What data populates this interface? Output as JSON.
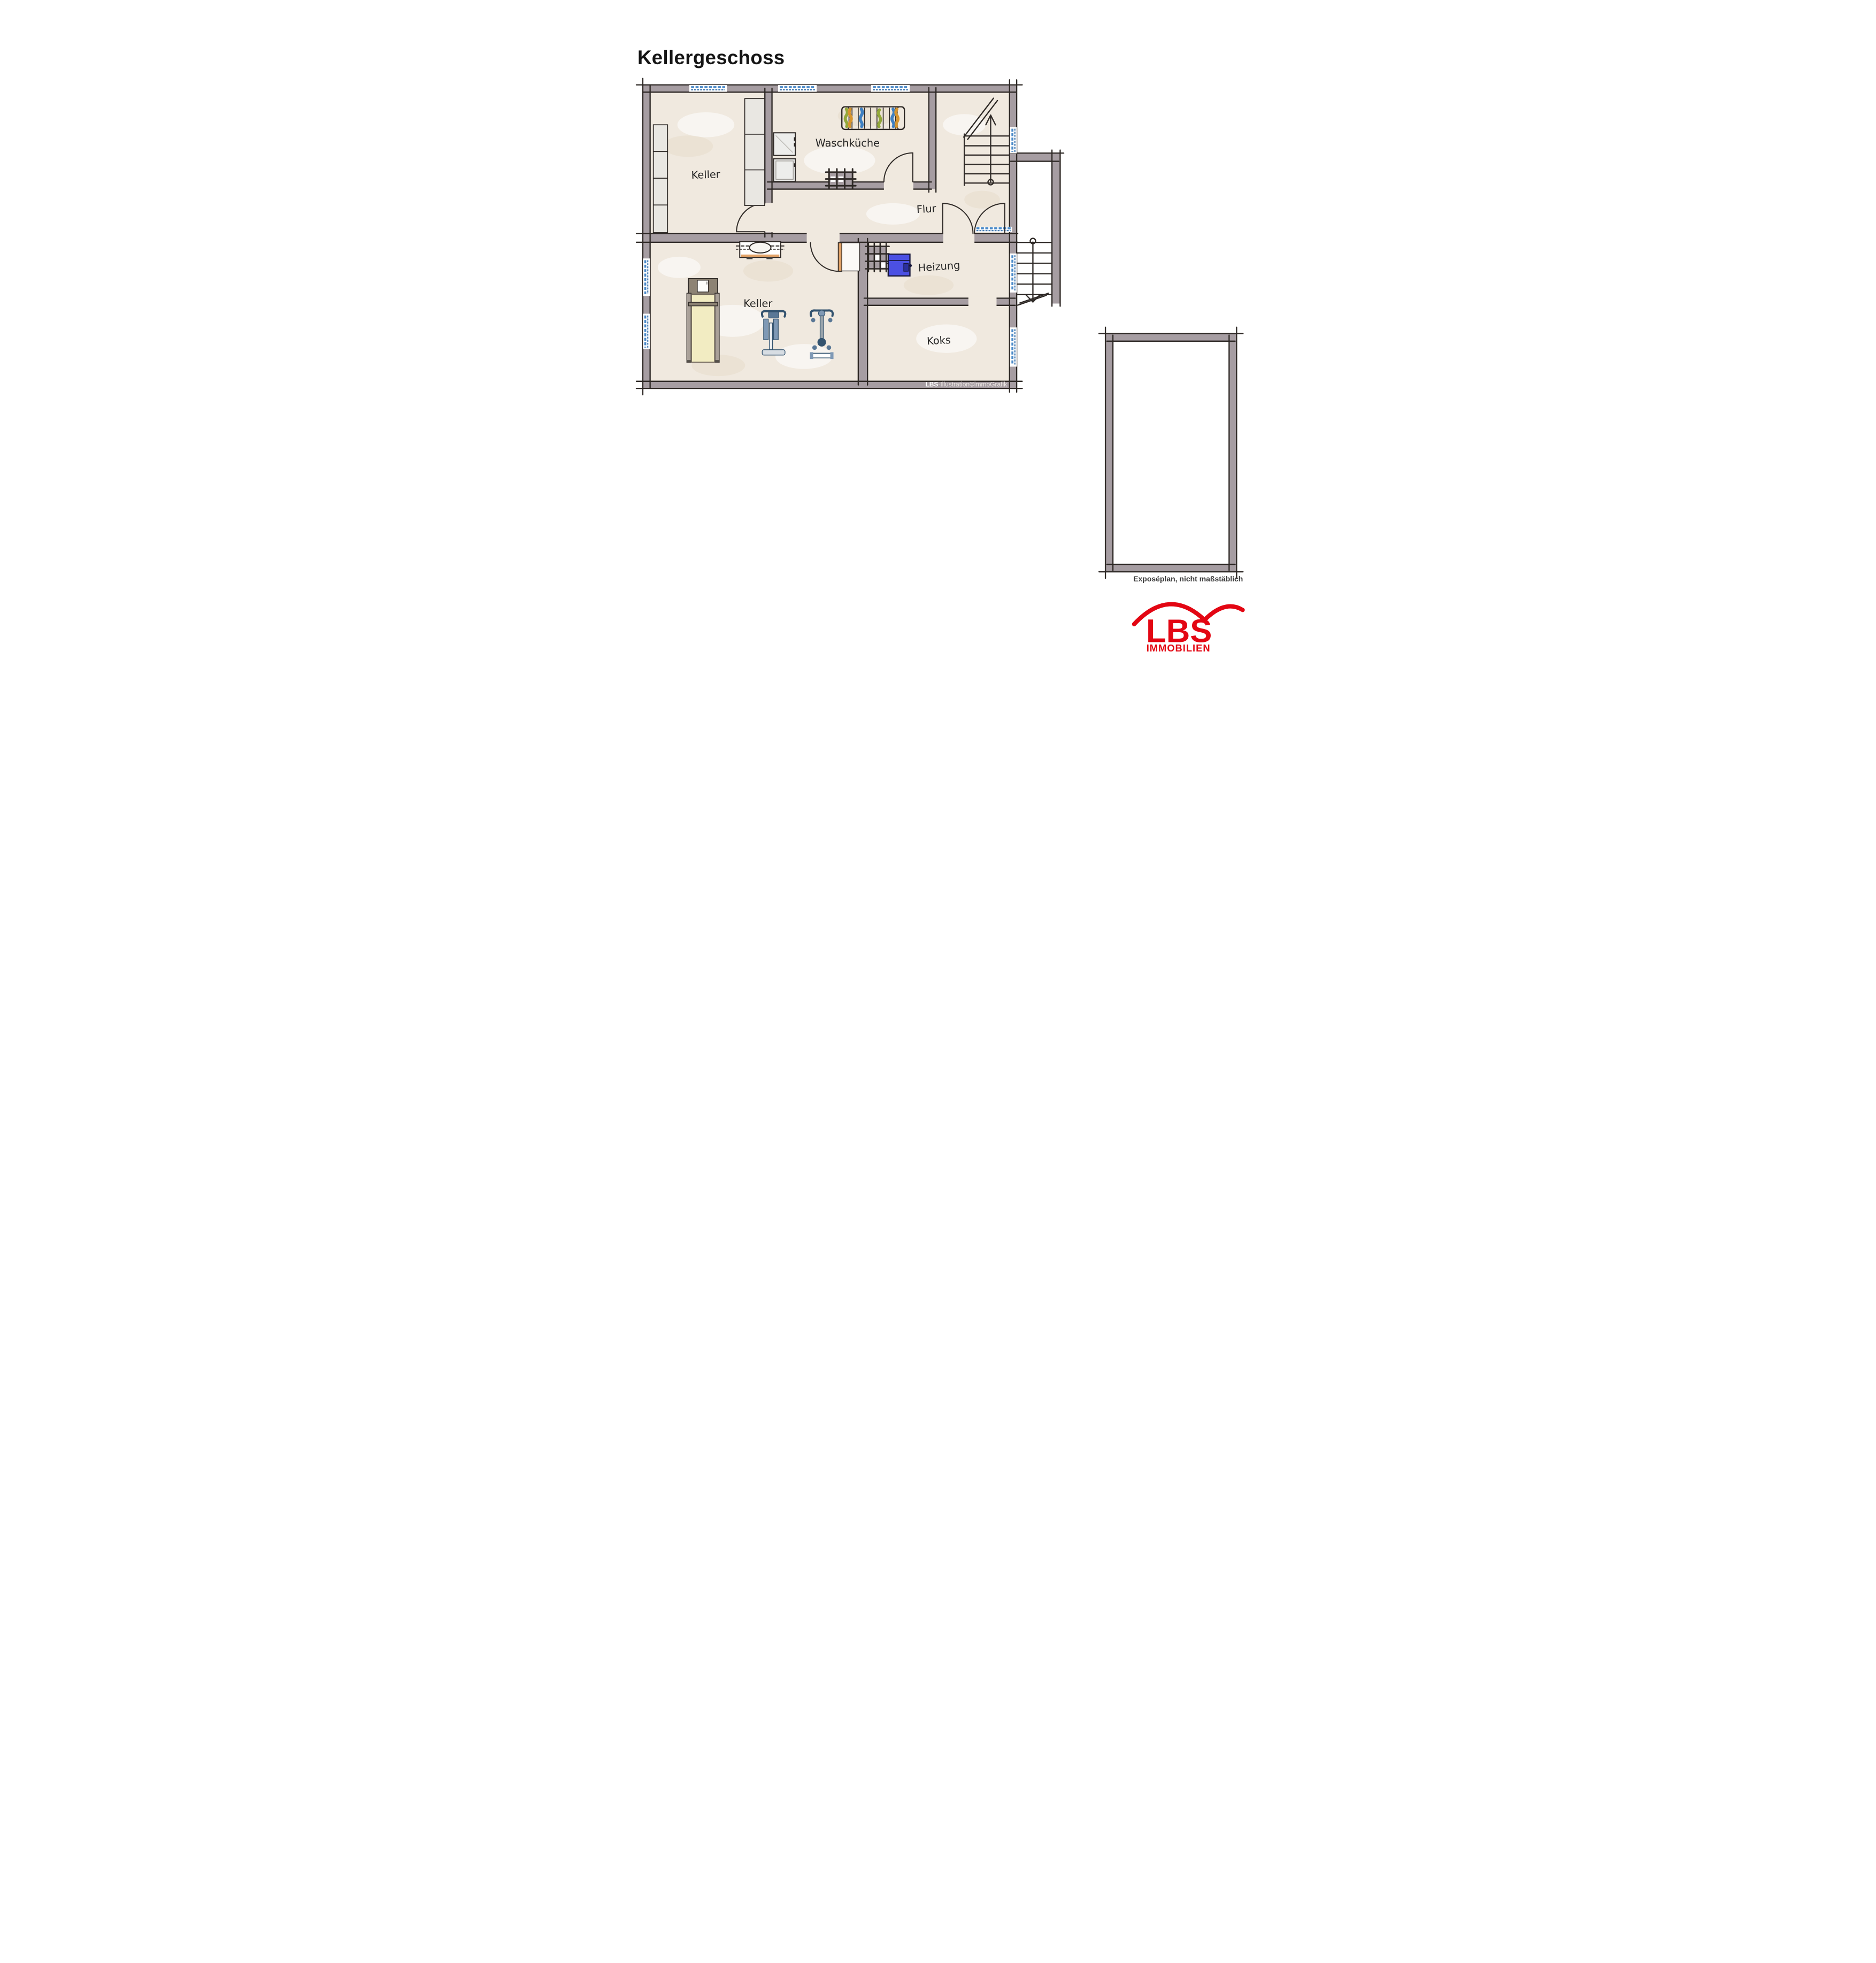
{
  "title": "Kellergeschoss",
  "plan": {
    "rooms": [
      {
        "id": "keller-top",
        "label": "Keller"
      },
      {
        "id": "waschkueche",
        "label": "Waschküche"
      },
      {
        "id": "flur",
        "label": "Flur"
      },
      {
        "id": "keller-unten",
        "label": "Keller"
      },
      {
        "id": "heizung",
        "label": "Heizung"
      },
      {
        "id": "koks",
        "label": "Koks"
      }
    ],
    "copyright_bold": "LBS",
    "copyright_rest": "-Illustration©immoGrafik"
  },
  "footnote": "Exposéplan, nicht maßstäblich",
  "logo": {
    "name": "LBS",
    "subtitle": "IMMOBILIEN",
    "color": "#e30613"
  },
  "colors": {
    "wall": "#a69da2",
    "floor": "#f0e9df",
    "line": "#2e2926",
    "window_blue": "#4a89c8",
    "boiler_blue": "#4b50e3",
    "door_wood": "#e2a368",
    "logo_red": "#e30613"
  }
}
